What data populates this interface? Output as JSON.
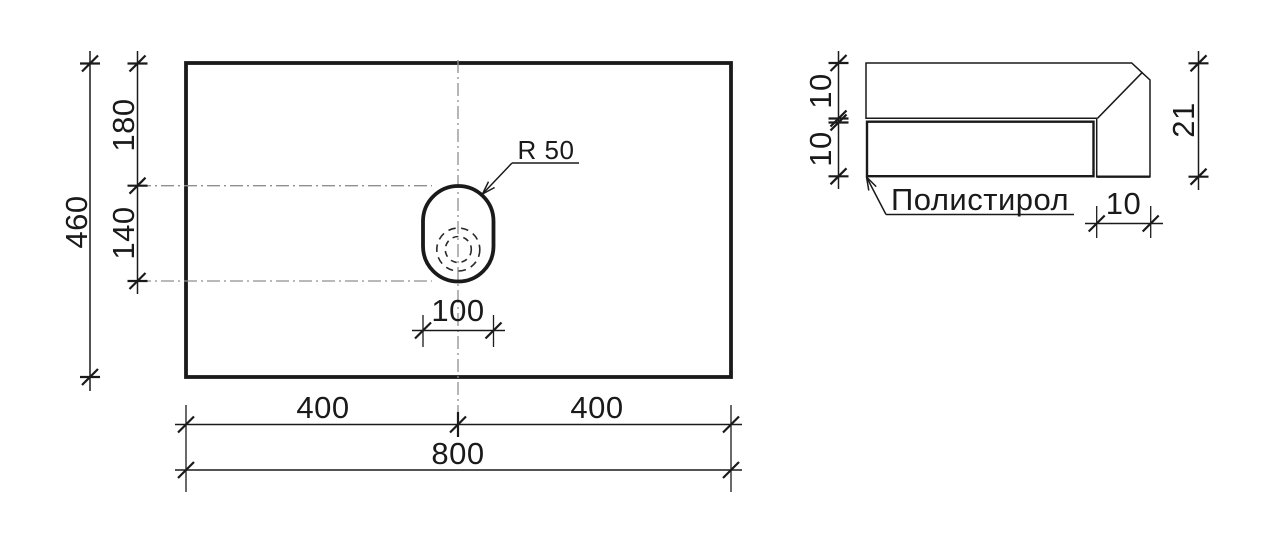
{
  "plan_view": {
    "dims": {
      "height_total": "460",
      "offset_top": "180",
      "hole_height": "140",
      "hole_radius_label": "R 50",
      "hole_width": "100",
      "width_left": "400",
      "width_right": "400",
      "width_total": "800"
    }
  },
  "section_view": {
    "material_label": "Полистирол",
    "dims": {
      "layer_top": "10",
      "layer_bottom": "10",
      "thickness_total": "21",
      "edge_width": "10"
    }
  },
  "colors": {
    "line": "#1a1a1a",
    "centerline": "#8f8f8f",
    "hatch_stroke": "#a0a0a0",
    "hatch_background": "#f1f1f1",
    "page_background": "#ffffff"
  }
}
